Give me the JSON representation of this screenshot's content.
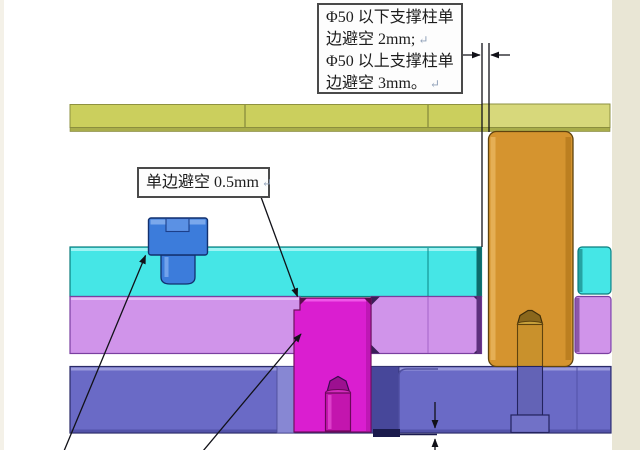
{
  "figure": {
    "type": "mold-cross-section-diagram",
    "callouts": {
      "pillar_gap_note": {
        "lines": [
          "Φ50 以下支撑柱单",
          "边避空 2mm;",
          "Φ50 以上支撑柱单",
          "边避空 3mm。"
        ],
        "return_mark": "↵"
      },
      "insert_gap_note": {
        "text": "单边避空 0.5mm",
        "return_mark": "↵"
      }
    },
    "colors": {
      "top_plate_yellow": "#cbcf5d",
      "top_plate_yellow_light": "#d7d87b",
      "top_plate_edge": "#a9ad4b",
      "cyan_plate": "#45e6e6",
      "violet_plate": "#d094ea",
      "bottom_plate_blue": "#6a6ac6",
      "pocket_dark_blue": "#47479a",
      "support_pillar_orange": "#d5942f",
      "insert_magenta": "#da1ed0",
      "insert_screw_magenta": "#c315ae",
      "screw_blue": "#3c7cdb",
      "pillar_screw_upper": "#c9912c",
      "pillar_screw_lower": "#6363b6",
      "gap_shade_teal": "#0d5f5f",
      "gap_shade_purple": "#5d2f7d",
      "annotation_line": "#1a1a26",
      "side_strip_beige": "#e9e6d5",
      "background": "#ffffff"
    }
  }
}
